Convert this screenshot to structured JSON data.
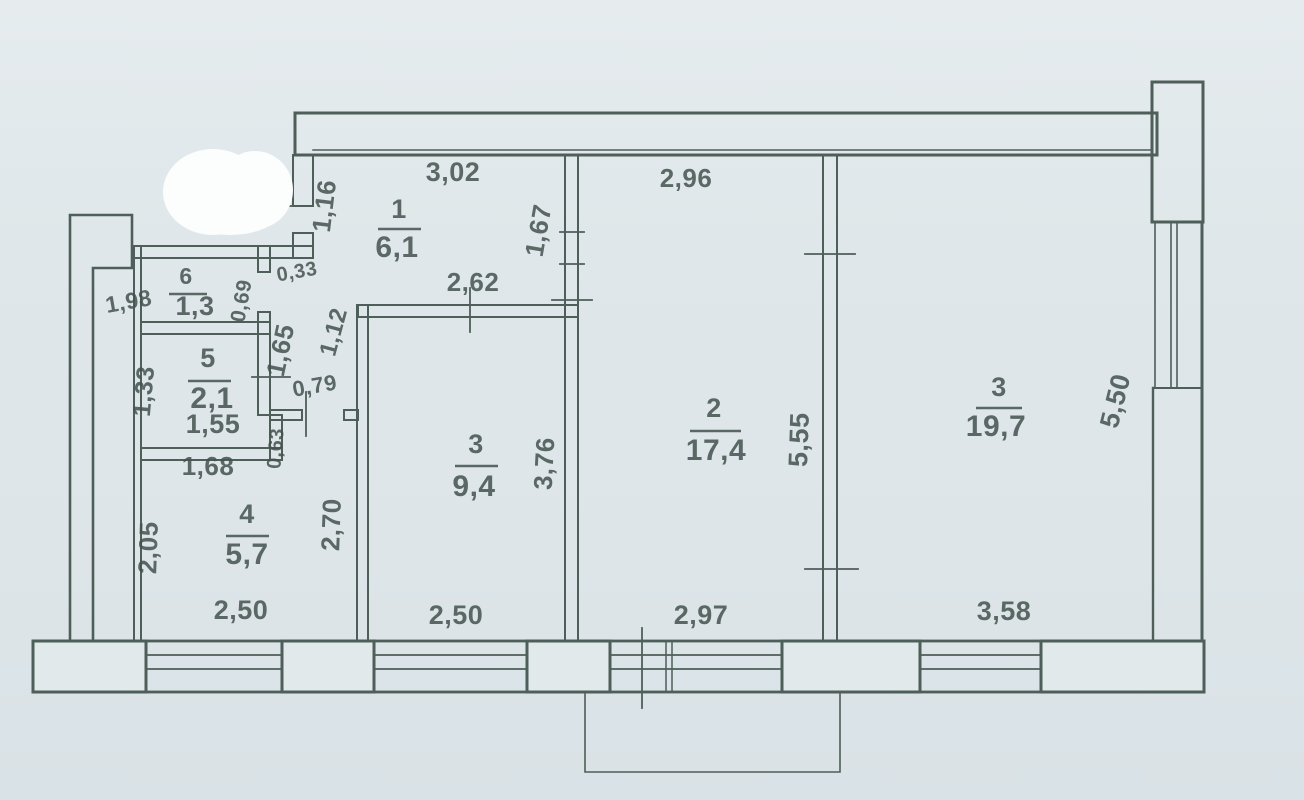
{
  "document": {
    "type": "apartment-floor-plan-scan"
  },
  "colors": {
    "background": "#dfe7ea",
    "wall_line": "#4e5e58",
    "text": "#44534e",
    "erase_blob": "#fcfdfd"
  },
  "plan": {
    "rooms": [
      {
        "number": "1",
        "area": "6,1",
        "nx": 399,
        "ny": 218,
        "ns": 27,
        "ax": 397,
        "ay": 257,
        "as": 30,
        "ulx1": 378,
        "ulx2": 421,
        "uly": 229
      },
      {
        "number": "2",
        "area": "17,4",
        "nx": 714,
        "ny": 417,
        "ns": 27,
        "ax": 716,
        "ay": 460,
        "as": 30,
        "ulx1": 690,
        "ulx2": 741,
        "uly": 431
      },
      {
        "number": "3",
        "area": "19,7",
        "nx": 999,
        "ny": 396,
        "ns": 27,
        "ax": 996,
        "ay": 436,
        "as": 30,
        "ulx1": 976,
        "ulx2": 1022,
        "uly": 408
      },
      {
        "number": "3",
        "area": "9,4",
        "nx": 476,
        "ny": 453,
        "ns": 27,
        "ax": 474,
        "ay": 496,
        "as": 30,
        "ulx1": 455,
        "ulx2": 498,
        "uly": 466
      },
      {
        "number": "4",
        "area": "5,7",
        "nx": 247,
        "ny": 523,
        "ns": 27,
        "ax": 247,
        "ay": 564,
        "as": 30,
        "ulx1": 226,
        "ulx2": 269,
        "uly": 536
      },
      {
        "number": "5",
        "area": "2,1",
        "nx": 208,
        "ny": 367,
        "ns": 27,
        "ax": 212,
        "ay": 408,
        "as": 30,
        "ulx1": 188,
        "ulx2": 231,
        "uly": 381
      },
      {
        "number": "6",
        "area": "1,3",
        "nx": 186,
        "ny": 284,
        "ns": 23,
        "ax": 195,
        "ay": 315,
        "as": 27,
        "ulx1": 169,
        "ulx2": 207,
        "uly": 294
      }
    ],
    "dimensions": [
      {
        "t": "3,02",
        "x": 453,
        "y": 181,
        "r": 0,
        "s": 27
      },
      {
        "t": "2,96",
        "x": 686,
        "y": 187,
        "r": 0,
        "s": 26
      },
      {
        "t": "1,16",
        "x": 333,
        "y": 207,
        "r": -83,
        "s": 26
      },
      {
        "t": "1,67",
        "x": 547,
        "y": 232,
        "r": -80,
        "s": 26
      },
      {
        "t": "2,62",
        "x": 473,
        "y": 291,
        "r": 0,
        "s": 26
      },
      {
        "t": "0,33",
        "x": 298,
        "y": 278,
        "r": -10,
        "s": 20
      },
      {
        "t": "1,98",
        "x": 130,
        "y": 309,
        "r": -10,
        "s": 23
      },
      {
        "t": "0,69",
        "x": 248,
        "y": 302,
        "r": -80,
        "s": 21
      },
      {
        "t": "1,65",
        "x": 289,
        "y": 352,
        "r": -78,
        "s": 26
      },
      {
        "t": "1,12",
        "x": 341,
        "y": 334,
        "r": -75,
        "s": 24
      },
      {
        "t": "0,79",
        "x": 316,
        "y": 393,
        "r": -10,
        "s": 22
      },
      {
        "t": "1,33",
        "x": 152,
        "y": 392,
        "r": -85,
        "s": 25
      },
      {
        "t": "1,55",
        "x": 213,
        "y": 433,
        "r": 0,
        "s": 27
      },
      {
        "t": "0,63",
        "x": 282,
        "y": 449,
        "r": -85,
        "s": 20
      },
      {
        "t": "1,68",
        "x": 208,
        "y": 475,
        "r": 0,
        "s": 26
      },
      {
        "t": "2,05",
        "x": 157,
        "y": 548,
        "r": -88,
        "s": 26
      },
      {
        "t": "2,70",
        "x": 340,
        "y": 525,
        "r": -88,
        "s": 26
      },
      {
        "t": "3,76",
        "x": 553,
        "y": 464,
        "r": -87,
        "s": 26
      },
      {
        "t": "5,55",
        "x": 808,
        "y": 440,
        "r": -88,
        "s": 27
      },
      {
        "t": "5,50",
        "x": 1124,
        "y": 403,
        "r": -76,
        "s": 27
      },
      {
        "t": "2,50",
        "x": 241,
        "y": 619,
        "r": 0,
        "s": 27
      },
      {
        "t": "2,50",
        "x": 456,
        "y": 624,
        "r": 0,
        "s": 27
      },
      {
        "t": "2,97",
        "x": 701,
        "y": 624,
        "r": 0,
        "s": 27
      },
      {
        "t": "3,58",
        "x": 1004,
        "y": 620,
        "r": 0,
        "s": 27
      }
    ]
  }
}
